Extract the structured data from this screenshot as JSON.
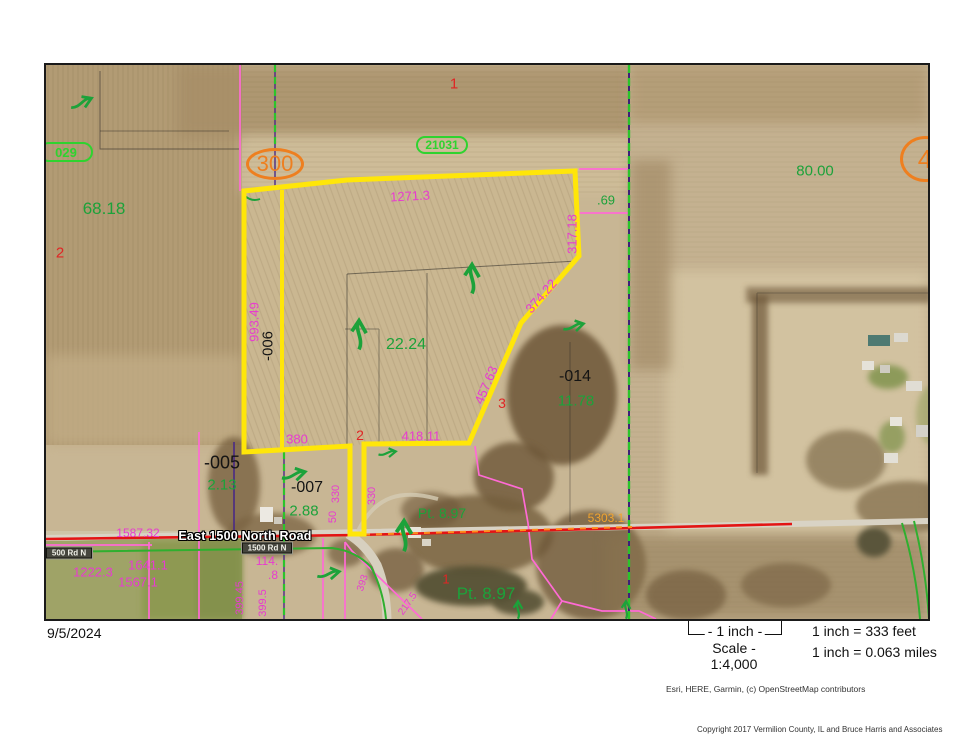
{
  "map": {
    "date": "9/5/2024",
    "road": {
      "name": "East 1500 North Road"
    },
    "labels": [
      {
        "t": "1271.3",
        "x": 364,
        "y": 131,
        "r": -3,
        "c": "m"
      },
      {
        "t": "317.18",
        "x": 526,
        "y": 169,
        "r": -90,
        "c": "m"
      },
      {
        "t": "374.22",
        "x": 495,
        "y": 231,
        "r": -49,
        "c": "m"
      },
      {
        "t": "457.63",
        "x": 440,
        "y": 320,
        "r": -67,
        "c": "m"
      },
      {
        "t": "418.11",
        "x": 375,
        "y": 371,
        "c": "m"
      },
      {
        "t": "380",
        "x": 251,
        "y": 374,
        "c": "m"
      },
      {
        "t": "993.49",
        "x": 208,
        "y": 257,
        "r": -90,
        "c": "m"
      },
      {
        "t": "330",
        "x": 290,
        "y": 429,
        "r": -90,
        "c": "m",
        "s": 11
      },
      {
        "t": "50",
        "x": 287,
        "y": 452,
        "r": -90,
        "c": "m",
        "s": 11
      },
      {
        "t": "330",
        "x": 326,
        "y": 431,
        "r": -90,
        "c": "m",
        "s": 11
      },
      {
        "t": "1587.32",
        "x": 92,
        "y": 468,
        "c": "m",
        "s": 12
      },
      {
        "t": "1222.3",
        "x": 47,
        "y": 507,
        "c": "m"
      },
      {
        "t": "1641.1",
        "x": 102,
        "y": 500,
        "c": "m"
      },
      {
        "t": "1567.1",
        "x": 92,
        "y": 517,
        "c": "m"
      },
      {
        "t": "114.",
        "x": 221,
        "y": 496,
        "c": "m",
        "s": 12
      },
      {
        "t": ".8",
        "x": 227,
        "y": 510,
        "c": "m",
        "s": 12
      },
      {
        "t": "399.45",
        "x": 194,
        "y": 533,
        "r": -90,
        "c": "m",
        "s": 11
      },
      {
        "t": "399.5",
        "x": 217,
        "y": 538,
        "r": -90,
        "c": "m",
        "s": 11
      },
      {
        "t": "393",
        "x": 317,
        "y": 518,
        "r": -72,
        "c": "m",
        "s": 10
      },
      {
        "t": "217.5",
        "x": 362,
        "y": 539,
        "r": -55,
        "c": "m",
        "s": 10
      },
      {
        "t": "68.18",
        "x": 58,
        "y": 144,
        "c": "g",
        "s": 17
      },
      {
        "t": "80.00",
        "x": 769,
        "y": 106,
        "c": "g",
        "s": 15
      },
      {
        "t": "22.24",
        "x": 360,
        "y": 280,
        "c": "g",
        "s": 16
      },
      {
        "t": "11.78",
        "x": 530,
        "y": 336,
        "c": "g",
        "s": 15
      },
      {
        "t": "2.13",
        "x": 176,
        "y": 420,
        "c": "g",
        "s": 15
      },
      {
        "t": "2.88",
        "x": 258,
        "y": 446,
        "c": "g",
        "s": 15
      },
      {
        "t": "Pt. 8.97",
        "x": 396,
        "y": 448,
        "c": "g",
        "s": 14
      },
      {
        "t": "Pt. 8.97",
        "x": 440,
        "y": 529,
        "c": "g",
        "s": 17
      },
      {
        "t": ".69",
        "x": 560,
        "y": 135,
        "c": "g",
        "s": 13
      },
      {
        "t": "-006",
        "x": 222,
        "y": 281,
        "r": -90,
        "c": "k",
        "s": 15
      },
      {
        "t": "-014",
        "x": 529,
        "y": 312,
        "c": "k",
        "s": 16
      },
      {
        "t": "-005",
        "x": 176,
        "y": 398,
        "c": "k",
        "s": 18
      },
      {
        "t": "-007",
        "x": 261,
        "y": 423,
        "c": "k",
        "s": 16
      },
      {
        "t": "1",
        "x": 408,
        "y": 19,
        "c": "r",
        "s": 15
      },
      {
        "t": "2",
        "x": 14,
        "y": 188,
        "c": "r",
        "s": 15
      },
      {
        "t": "2",
        "x": 314,
        "y": 370,
        "c": "r",
        "s": 14
      },
      {
        "t": "3",
        "x": 456,
        "y": 338,
        "c": "r",
        "s": 14
      },
      {
        "t": "1",
        "x": 400,
        "y": 514,
        "c": "r",
        "s": 13
      },
      {
        "t": "5303.1",
        "x": 560,
        "y": 453,
        "c": "o",
        "s": 12
      },
      {
        "t": "East 1500 North Road",
        "x": 199,
        "y": 471,
        "c": "roadname"
      },
      {
        "t": "1500 Rd N",
        "x": 221,
        "y": 483,
        "c": "bdgdark",
        "w": 50,
        "h": 11
      },
      {
        "t": "500 Rd N",
        "x": 23,
        "y": 488,
        "c": "bdgdark",
        "w": 46,
        "h": 11
      },
      {
        "t": "029",
        "x": 20,
        "y": 87,
        "c": "bdggreen",
        "w": 54,
        "h": 20
      },
      {
        "t": "21031",
        "x": 396,
        "y": 80,
        "c": "bdggreen",
        "w": 52,
        "h": 18,
        "s": 12
      },
      {
        "t": "300",
        "x": 229,
        "y": 99,
        "c": "ovalorange",
        "w": 58,
        "h": 32,
        "s": 22
      },
      {
        "t": "4",
        "x": 879,
        "y": 94,
        "c": "ovalorange",
        "w": 50,
        "h": 46,
        "s": 26
      }
    ],
    "colors": {
      "parcel_highlight": "#ffe609",
      "dimension_text": "#e83bd0",
      "acreage_text": "#1ca23a",
      "parcel_number_text": "#141414",
      "lot_number_text": "#e02525",
      "route_marker": "#ee7f1f",
      "survey_badge": "#2fd32f",
      "section_line": "#2bc42b",
      "road_line": "#e31414",
      "road_measure": "#f2a42d"
    }
  },
  "footer": {
    "scale_bar": "- 1 inch -",
    "scale_ratio": "Scale - 1:4,000",
    "scale_feet": "1 inch = 333 feet",
    "scale_miles": "1 inch = 0.063 miles",
    "attribution": "Esri, HERE, Garmin, (c) OpenStreetMap contributors",
    "copyright": "Copyright 2017 Vermilion County, IL and Bruce Harris and Associates"
  }
}
